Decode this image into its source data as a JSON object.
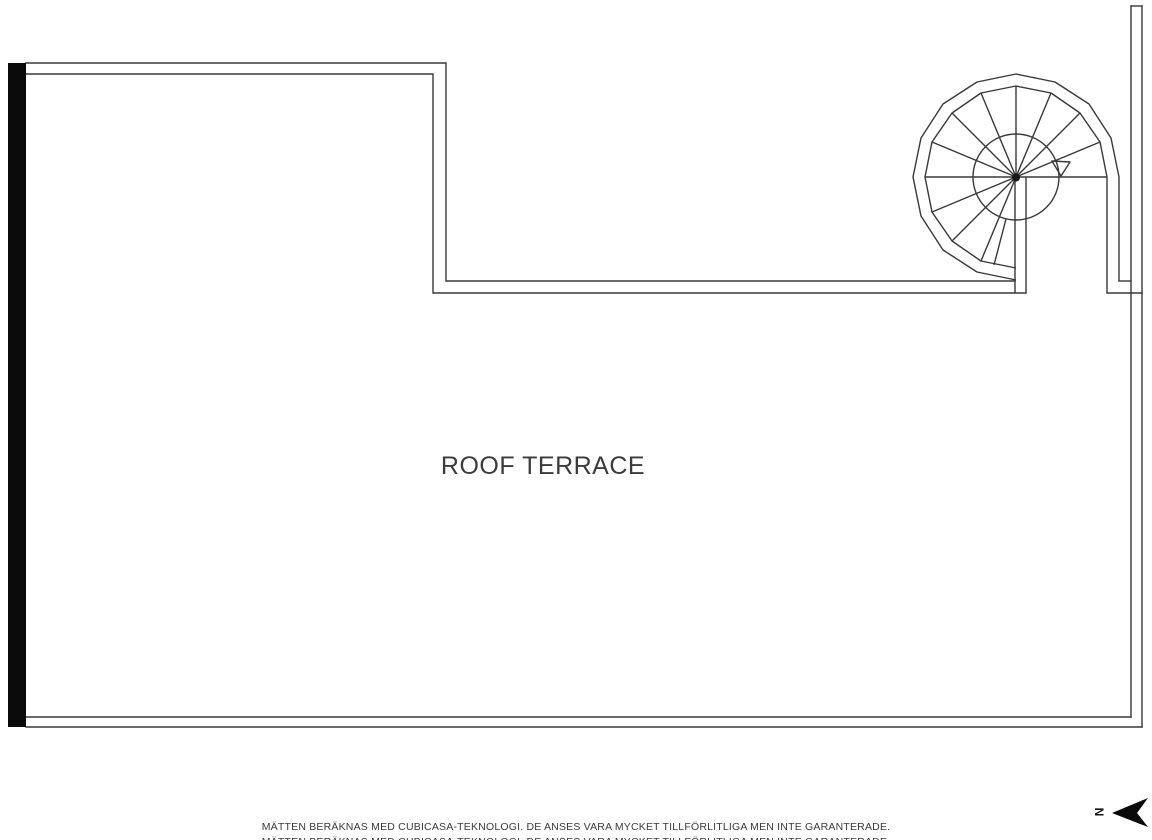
{
  "floorplan": {
    "room_label": "ROOF TERRACE"
  },
  "compass": {
    "north_label": "N"
  },
  "footer": {
    "disclaimer": "MÄTTEN BERÄKNAS MED CUBICASA-TEKNOLOGI. DE ANSES VARA MYCKET TILLFÖRLITLIGA MEN INTE GARANTERADE.",
    "disclaimer_line2": "MÄTTEN BERÄKNAS MED CUBICASA-TEKNOLOGI. DE ANSES VARA MYCKET TILLFÖRLITLIGA MEN INTE GARANTERADE."
  },
  "colors": {
    "wall_line": "#383838",
    "solid_wall": "#0a0a0a",
    "label_text": "#3b3b3b",
    "north_arrow": "#0a0a0a"
  }
}
